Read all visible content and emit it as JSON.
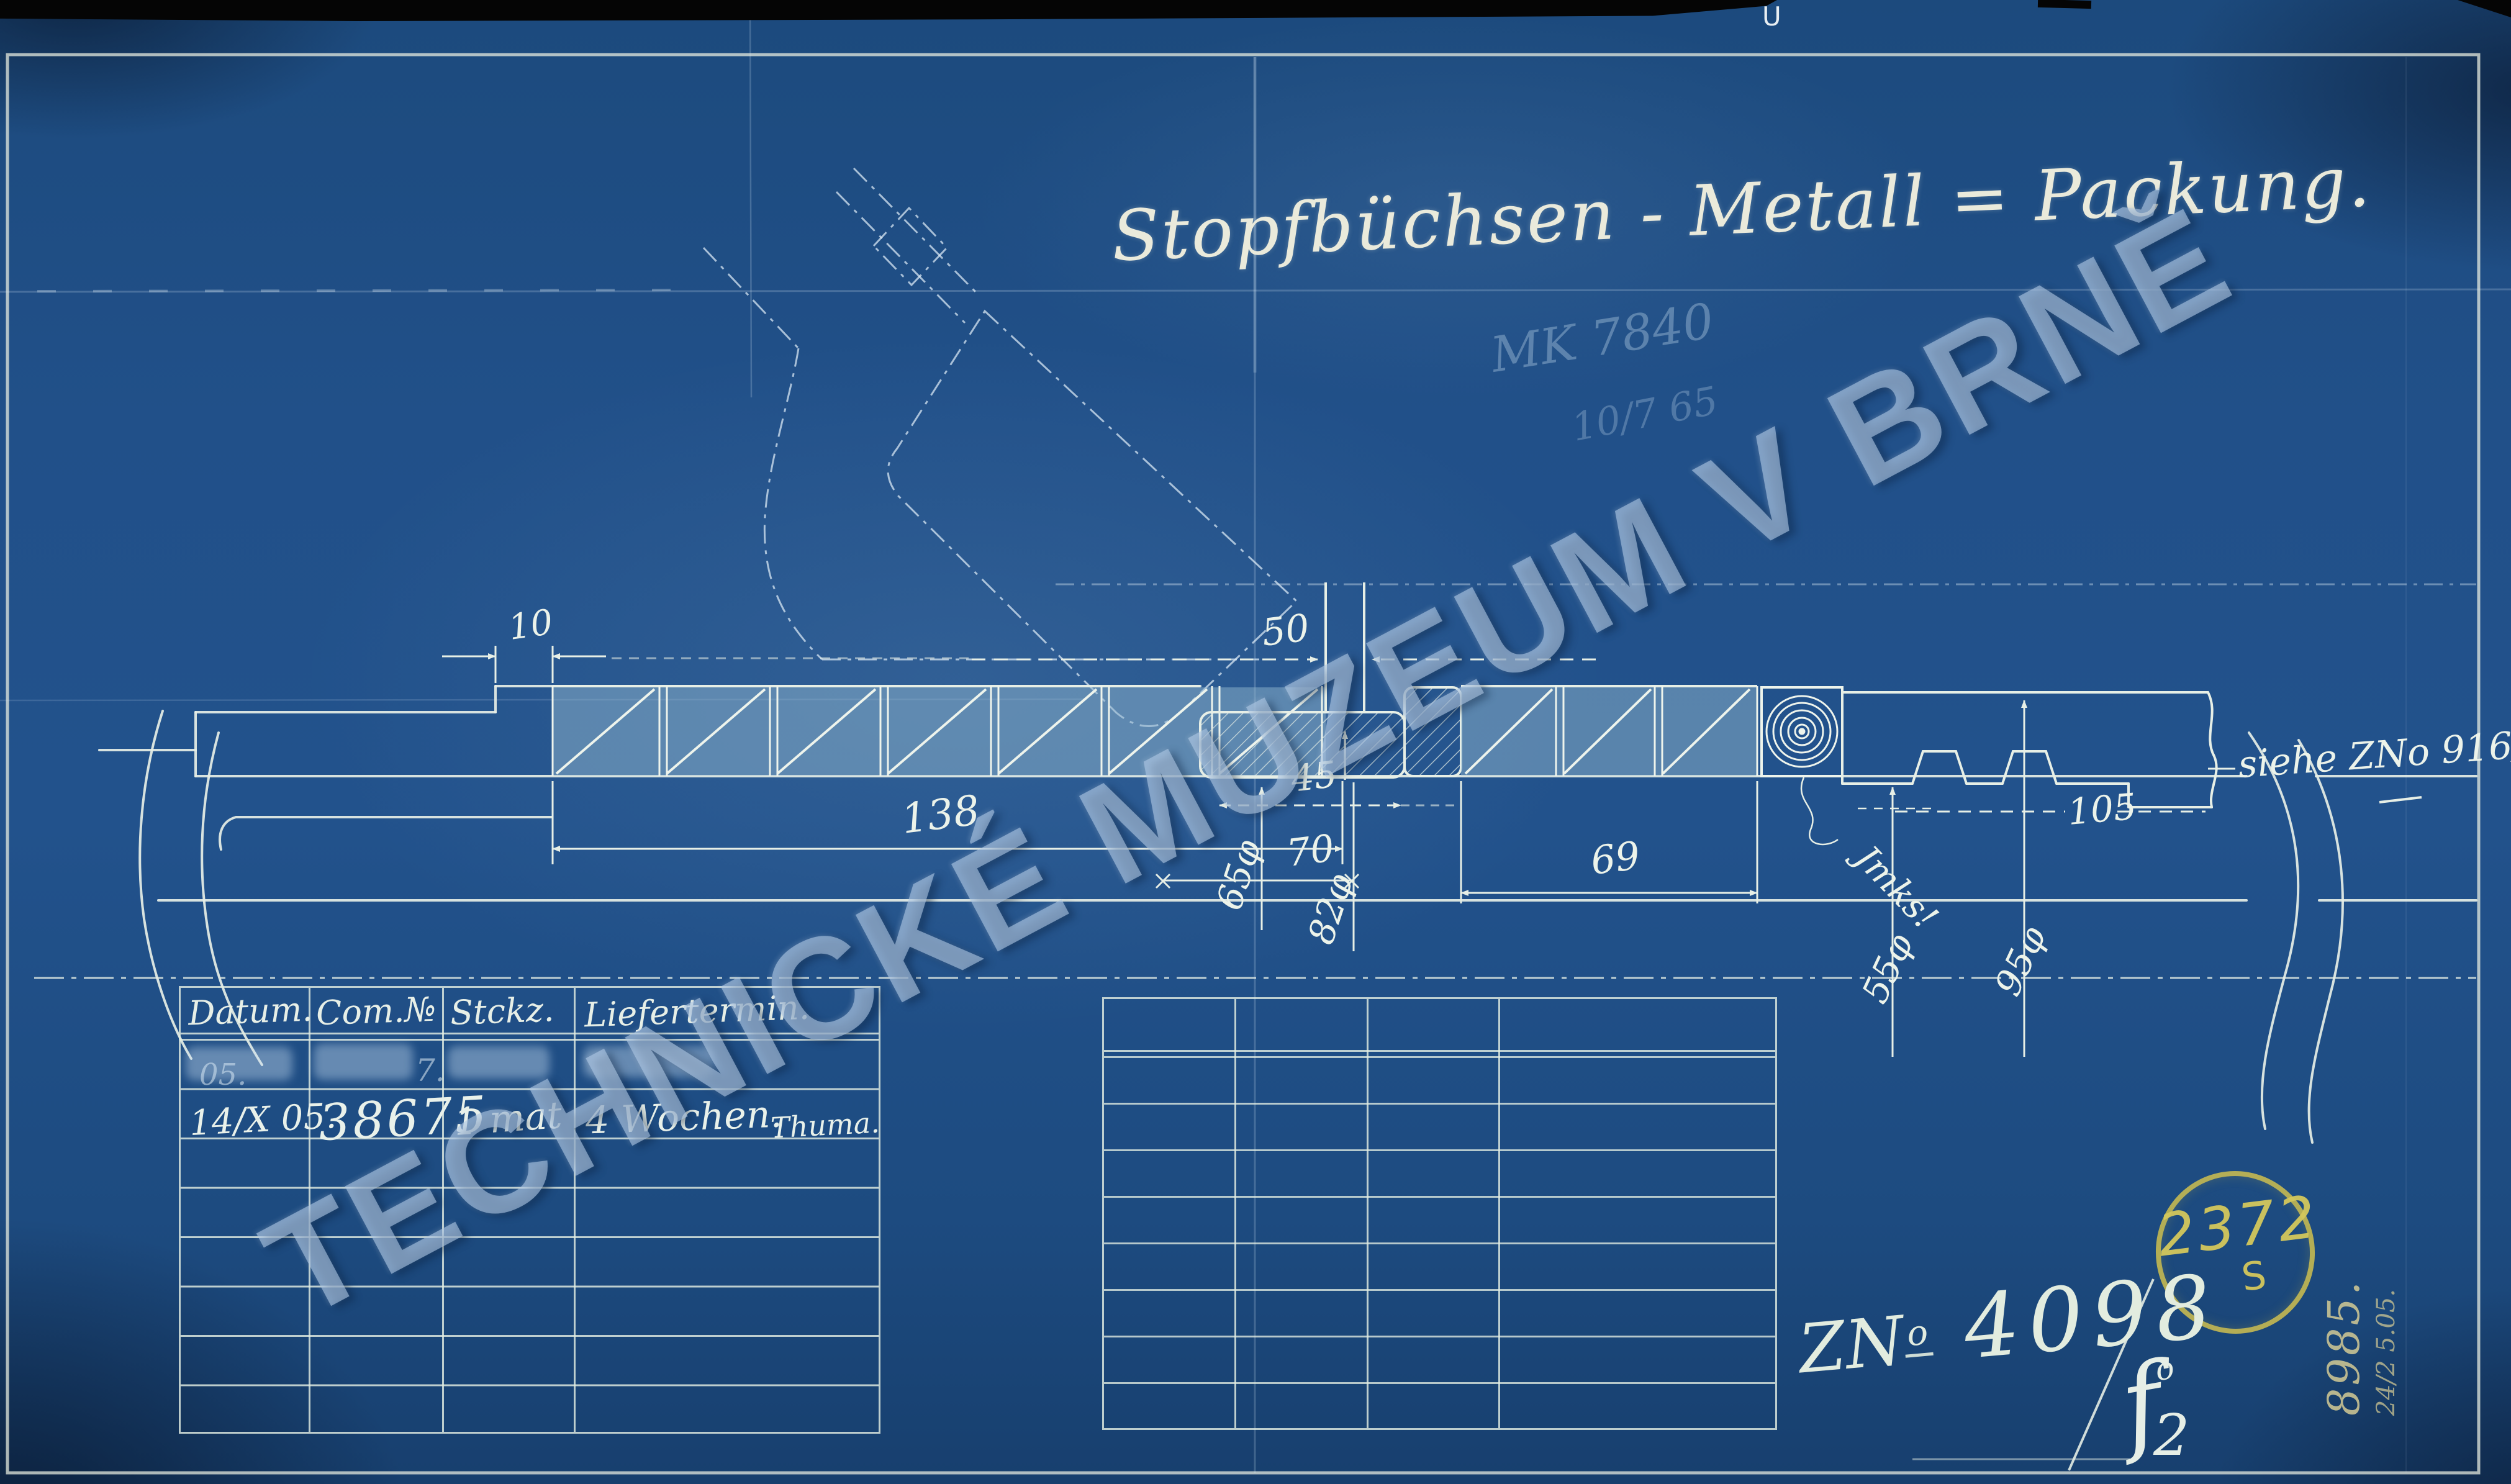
{
  "page": {
    "paper_blue": "#21508a",
    "line_cream": "#e7efe6",
    "stamp_yellow": "#c9bb54"
  },
  "header": {
    "title": "Stopfbüchsen - Metall = Packung.",
    "pencil_note": "MK 7840",
    "pencil_note2": "10/7 65",
    "edge_mark": "U"
  },
  "watermark": {
    "text": "TECHNICKÉ MUZEUM V BRNĚ"
  },
  "drawing": {
    "dims": {
      "d10": "10",
      "d50": "50",
      "d138": "138",
      "d45": "45",
      "d65": "65φ",
      "d70": "70",
      "d82": "82φ",
      "d69": "69",
      "d105": "105",
      "d55": "55φ",
      "d95": "95φ"
    },
    "ref_note": "siehe ZNo 916/xx.",
    "spiral_note": "Jmks!"
  },
  "table_left": {
    "headers": [
      "Datum.",
      "Com.№",
      "Stckz.",
      "Liefertermin."
    ],
    "erased_row": {
      "datum": "05.",
      "com_no": "7."
    },
    "entry_row": {
      "datum": "14/X 05.",
      "com_no": "38675",
      "stckz": "1 mat",
      "liefertermin": "4 Wochen.",
      "signature": "Thuma."
    }
  },
  "marks": {
    "stamp_number": "2372",
    "stamp_letter": "S",
    "zno_prefix": "ZN",
    "zno_sup": "o",
    "zno_number": "4098",
    "side_number": "8985.",
    "side_date": "24/2 5.05.",
    "check_letter": "f",
    "check_sup": "o",
    "sheet_number": "2"
  }
}
